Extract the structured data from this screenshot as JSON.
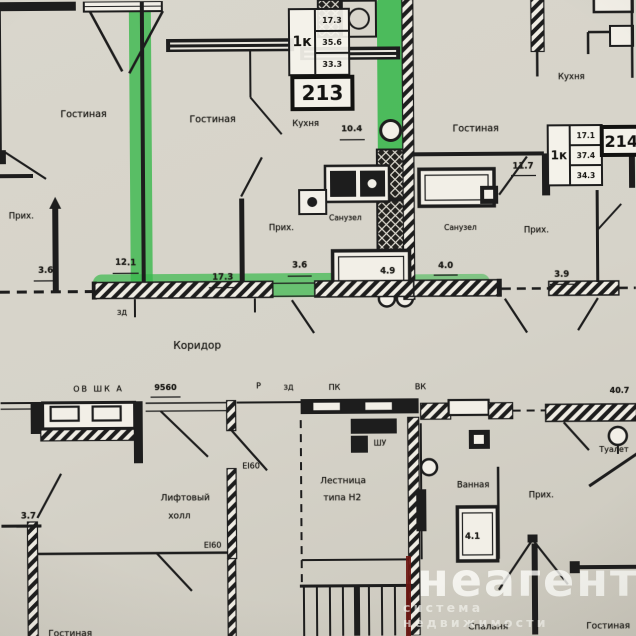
{
  "plan": {
    "apartments": {
      "apt_left": {
        "rooms": {
          "living": "Гостиная",
          "hall": "Прих."
        },
        "dims": {
          "hall": "3.6"
        }
      },
      "apt213": {
        "number": "213",
        "type": "1к",
        "areas": [
          "17.3",
          "35.6",
          "33.3"
        ],
        "rooms": {
          "living": "Гостиная",
          "kitchen": "Кухня",
          "hall": "Прих.",
          "bath": "Санузел"
        },
        "dims": {
          "left": "12.1",
          "living": "17.3",
          "kitchen": "10.4",
          "hall": "3.6",
          "bath": "4.9"
        }
      },
      "apt214": {
        "number": "214",
        "type": "1к",
        "areas": [
          "17.1",
          "37.4",
          "34.3"
        ],
        "rooms": {
          "living": "Гостиная",
          "kitchen": "Кухня",
          "hall": "Прих.",
          "bath": "Санузел"
        },
        "dims": {
          "kitchen": "11.7",
          "bath": "4.0",
          "hall": "3.9"
        }
      }
    },
    "corridor": {
      "label": "Коридор",
      "marks": {
        "door_left": "ЗД",
        "p": "Р",
        "door_mid": "ЗД",
        "pk": "ПК",
        "vk": "ВК"
      }
    },
    "lower": {
      "vent_row": "ОВ ШК А",
      "dim_width": "9560",
      "lift_hall": {
        "line1": "Лифтовый",
        "line2": "холл"
      },
      "stairs": {
        "line1": "Лестница",
        "line2": "типа Н2"
      },
      "shu": "ШУ",
      "fire_doors": {
        "top": "EI60",
        "side": "EI60"
      },
      "rooms": {
        "bath": "Ванная",
        "hall": "Прих.",
        "toilet": "Туалет",
        "bedroom": "Спальня",
        "living_right": "Гостиная",
        "living_left": "Гостиная"
      },
      "dims": {
        "bath": "4.1",
        "left": "3.7",
        "right": "40.7"
      }
    },
    "watermark": {
      "brand": "неагент",
      "tagline": "система недвижимости"
    },
    "colors": {
      "highlight": "#35ba47",
      "ink": "#1d1d1d",
      "paper": "#d6d3c9",
      "brand_red": "#6e1712"
    }
  }
}
